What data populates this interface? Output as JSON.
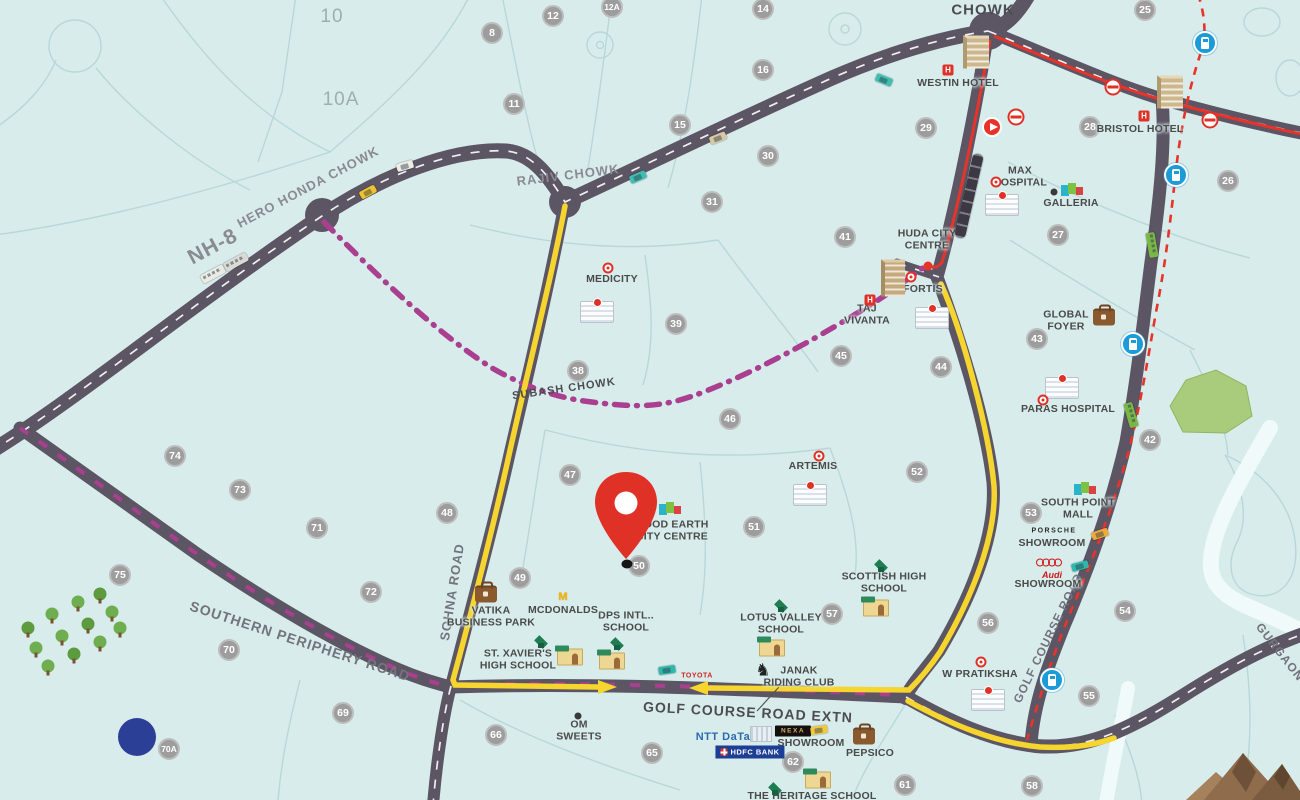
{
  "map": {
    "colors": {
      "background": "#d8ecec",
      "block_lines": "#b9d7d8",
      "road": "#5c5564",
      "route_yellow": "#f6d52f",
      "route_magenta": "#aa3f90",
      "route_red": "#e8332a",
      "pin_red": "#e03127",
      "sector_circle": "#9d9d9d",
      "metro_blue": "#1b9bd8",
      "park_green": "#a9cb7c",
      "mountain_brown": "#8f6d4c",
      "pond_blue": "#2b3f96"
    },
    "area_labels": [
      {
        "t": "10",
        "x": 332,
        "y": 17
      },
      {
        "t": "10A",
        "x": 341,
        "y": 100
      }
    ],
    "road_labels": [
      {
        "t": "NH-8",
        "x": 213,
        "y": 247,
        "s": 21,
        "r": -28,
        "cls": ""
      },
      {
        "t": "HERO HONDA CHOWK",
        "x": 308,
        "y": 187,
        "s": 13,
        "r": -28,
        "cls": ""
      },
      {
        "t": "RAJIV CHOWK",
        "x": 568,
        "y": 175,
        "s": 13,
        "r": -7,
        "cls": ""
      },
      {
        "t": "CHOWK",
        "x": 983,
        "y": 10,
        "s": 15,
        "r": 0,
        "cls": "dark"
      },
      {
        "t": "SUBASH CHOWK",
        "x": 564,
        "y": 389,
        "s": 11,
        "r": -8,
        "cls": "dark"
      },
      {
        "t": "SOHNA ROAD",
        "x": 452,
        "y": 592,
        "s": 13,
        "r": -81,
        "cls": "med"
      },
      {
        "t": "GOLF COURSE ROAD",
        "x": 1048,
        "y": 638,
        "s": 12,
        "r": -64,
        "cls": "med"
      },
      {
        "t": "GOLF COURSE ROAD EXTN",
        "x": 748,
        "y": 712,
        "s": 14,
        "r": 3,
        "cls": "dark"
      },
      {
        "t": "SOUTHERN PERIPHERY ROAD",
        "x": 300,
        "y": 641,
        "s": 14,
        "r": 18,
        "cls": "med"
      },
      {
        "t": "GURGAON",
        "x": 1280,
        "y": 652,
        "s": 12,
        "r": 52,
        "cls": "med"
      }
    ],
    "sectors": [
      {
        "n": "8",
        "x": 492,
        "y": 33
      },
      {
        "n": "11",
        "x": 514,
        "y": 104
      },
      {
        "n": "12",
        "x": 553,
        "y": 16
      },
      {
        "n": "12A",
        "x": 612,
        "y": 7
      },
      {
        "n": "14",
        "x": 763,
        "y": 9
      },
      {
        "n": "15",
        "x": 680,
        "y": 125
      },
      {
        "n": "16",
        "x": 763,
        "y": 70
      },
      {
        "n": "25",
        "x": 1145,
        "y": 10
      },
      {
        "n": "26",
        "x": 1228,
        "y": 181
      },
      {
        "n": "27",
        "x": 1058,
        "y": 235
      },
      {
        "n": "28",
        "x": 1090,
        "y": 127
      },
      {
        "n": "29",
        "x": 926,
        "y": 128
      },
      {
        "n": "30",
        "x": 768,
        "y": 156
      },
      {
        "n": "31",
        "x": 712,
        "y": 202
      },
      {
        "n": "38",
        "x": 578,
        "y": 371
      },
      {
        "n": "39",
        "x": 676,
        "y": 324
      },
      {
        "n": "41",
        "x": 845,
        "y": 237
      },
      {
        "n": "42",
        "x": 1150,
        "y": 440
      },
      {
        "n": "43",
        "x": 1037,
        "y": 339
      },
      {
        "n": "44",
        "x": 941,
        "y": 367
      },
      {
        "n": "45",
        "x": 841,
        "y": 356
      },
      {
        "n": "46",
        "x": 730,
        "y": 419
      },
      {
        "n": "47",
        "x": 570,
        "y": 475
      },
      {
        "n": "48",
        "x": 447,
        "y": 513
      },
      {
        "n": "49",
        "x": 520,
        "y": 578
      },
      {
        "n": "50",
        "x": 639,
        "y": 566
      },
      {
        "n": "51",
        "x": 754,
        "y": 527
      },
      {
        "n": "52",
        "x": 917,
        "y": 472
      },
      {
        "n": "53",
        "x": 1031,
        "y": 513
      },
      {
        "n": "54",
        "x": 1125,
        "y": 611
      },
      {
        "n": "55",
        "x": 1089,
        "y": 696
      },
      {
        "n": "56",
        "x": 988,
        "y": 623
      },
      {
        "n": "57",
        "x": 832,
        "y": 614
      },
      {
        "n": "58",
        "x": 1032,
        "y": 786
      },
      {
        "n": "61",
        "x": 905,
        "y": 785
      },
      {
        "n": "62",
        "x": 793,
        "y": 762
      },
      {
        "n": "65",
        "x": 652,
        "y": 753
      },
      {
        "n": "66",
        "x": 496,
        "y": 735
      },
      {
        "n": "69",
        "x": 343,
        "y": 713
      },
      {
        "n": "70",
        "x": 229,
        "y": 650
      },
      {
        "n": "70A",
        "x": 169,
        "y": 749
      },
      {
        "n": "71",
        "x": 317,
        "y": 528
      },
      {
        "n": "72",
        "x": 371,
        "y": 592
      },
      {
        "n": "73",
        "x": 240,
        "y": 490
      },
      {
        "n": "74",
        "x": 175,
        "y": 456
      },
      {
        "n": "75",
        "x": 120,
        "y": 575
      }
    ],
    "poi_labels": [
      {
        "t": "WESTIN HOTEL",
        "x": 958,
        "y": 83
      },
      {
        "t": "BRISTOL HOTEL",
        "x": 1140,
        "y": 129
      },
      {
        "t": "MAX\nHOSPITAL",
        "x": 1020,
        "y": 177
      },
      {
        "t": "GALLERIA",
        "x": 1071,
        "y": 203
      },
      {
        "t": "HUDA CITY\nCENTRE",
        "x": 927,
        "y": 240
      },
      {
        "t": "FORTIS",
        "x": 923,
        "y": 289
      },
      {
        "t": "TAJ\nVIVANTA",
        "x": 867,
        "y": 315
      },
      {
        "t": "MEDICITY",
        "x": 612,
        "y": 279
      },
      {
        "t": "GLOBAL\nFOYER",
        "x": 1066,
        "y": 321
      },
      {
        "t": "PARAS HOSPITAL",
        "x": 1068,
        "y": 409
      },
      {
        "t": "ARTEMIS",
        "x": 813,
        "y": 466
      },
      {
        "t": "GOOD EARTH\nCITY CENTRE",
        "x": 672,
        "y": 531
      },
      {
        "t": "SOUTH POINT\nMALL",
        "x": 1078,
        "y": 509
      },
      {
        "t": "SHOWROOM",
        "x": 1052,
        "y": 543
      },
      {
        "t": "SHOWROOM",
        "x": 1048,
        "y": 584
      },
      {
        "t": "SHOWROOM",
        "x": 811,
        "y": 743
      },
      {
        "t": "W PRATIKSHA",
        "x": 980,
        "y": 674
      },
      {
        "t": "SCOTTISH HIGH\nSCHOOL",
        "x": 884,
        "y": 583
      },
      {
        "t": "LOTUS VALLEY\nSCHOOL",
        "x": 781,
        "y": 624
      },
      {
        "t": "JANAK\nRIDING CLUB",
        "x": 799,
        "y": 677
      },
      {
        "t": "DPS INTL..\nSCHOOL",
        "x": 626,
        "y": 622
      },
      {
        "t": "ST. XAVIER'S\nHIGH SCHOOL",
        "x": 518,
        "y": 660
      },
      {
        "t": "MCDONALDS",
        "x": 563,
        "y": 610
      },
      {
        "t": "VATIKA\nBUSINESS PARK",
        "x": 491,
        "y": 617
      },
      {
        "t": "OM\nSWEETS",
        "x": 579,
        "y": 731
      },
      {
        "t": "PEPSICO",
        "x": 870,
        "y": 753
      },
      {
        "t": "THE HERITAGE SCHOOL",
        "x": 812,
        "y": 796
      }
    ],
    "logos": [
      {
        "t": "PORSCHE",
        "k": "porsche",
        "x": 1054,
        "y": 531
      },
      {
        "t": "Audi",
        "k": "audi-word",
        "x": 1052,
        "y": 575
      },
      {
        "t": "NTT DaTa",
        "k": "ntt",
        "x": 723,
        "y": 737
      },
      {
        "t": "TOYOTA",
        "k": "toyota",
        "x": 697,
        "y": 676
      },
      {
        "t": "NEXA",
        "k": "nexa",
        "x": 793,
        "y": 731
      },
      {
        "t": "HDFC BANK",
        "k": "hdfc",
        "x": 750,
        "y": 752
      }
    ],
    "icons": [
      {
        "k": "hotel",
        "name": "hotel-building-icon",
        "x": 976,
        "y": 52
      },
      {
        "k": "hotel",
        "name": "hotel-building-icon",
        "x": 1170,
        "y": 92
      },
      {
        "k": "hudabldg",
        "name": "tower-building-icon",
        "x": 893,
        "y": 278
      },
      {
        "k": "hbadge",
        "name": "hotel-h-badge-icon",
        "x": 948,
        "y": 70,
        "glyph": "H"
      },
      {
        "k": "hbadge",
        "name": "hotel-h-badge-icon",
        "x": 1144,
        "y": 116,
        "glyph": "H"
      },
      {
        "k": "hbadge",
        "name": "hotel-h-badge-icon",
        "x": 870,
        "y": 300,
        "glyph": "H"
      },
      {
        "k": "hospital",
        "name": "hospital-building-icon",
        "x": 1002,
        "y": 205
      },
      {
        "k": "hospital",
        "name": "hospital-building-icon",
        "x": 932,
        "y": 318
      },
      {
        "k": "hospital",
        "name": "hospital-building-icon",
        "x": 597,
        "y": 312
      },
      {
        "k": "hospital",
        "name": "hospital-building-icon",
        "x": 1062,
        "y": 388
      },
      {
        "k": "hospital",
        "name": "hospital-building-icon",
        "x": 810,
        "y": 495
      },
      {
        "k": "hospital",
        "name": "hospital-building-icon",
        "x": 988,
        "y": 700
      },
      {
        "k": "reddot",
        "name": "hospital-marker-icon",
        "x": 996,
        "y": 182
      },
      {
        "k": "reddot",
        "name": "hospital-marker-icon",
        "x": 608,
        "y": 268
      },
      {
        "k": "reddot",
        "name": "hospital-marker-icon",
        "x": 911,
        "y": 277
      },
      {
        "k": "reddot",
        "name": "hospital-marker-icon",
        "x": 819,
        "y": 456
      },
      {
        "k": "reddot",
        "name": "hospital-marker-icon",
        "x": 1043,
        "y": 400
      },
      {
        "k": "reddot",
        "name": "hospital-marker-icon",
        "x": 981,
        "y": 662
      },
      {
        "k": "blackdot",
        "name": "place-dot-icon",
        "x": 1054,
        "y": 192
      },
      {
        "k": "blackdot",
        "name": "place-dot-icon",
        "x": 578,
        "y": 716
      },
      {
        "k": "mall",
        "name": "mall-icon",
        "x": 1074,
        "y": 190
      },
      {
        "k": "mall",
        "name": "mall-icon",
        "x": 672,
        "y": 509
      },
      {
        "k": "mall",
        "name": "mall-icon",
        "x": 1087,
        "y": 489
      },
      {
        "k": "briefcase",
        "name": "business-park-icon",
        "x": 1104,
        "y": 317
      },
      {
        "k": "briefcase",
        "name": "business-park-icon",
        "x": 486,
        "y": 594
      },
      {
        "k": "briefcase",
        "name": "business-park-icon",
        "x": 864,
        "y": 736
      },
      {
        "k": "cap",
        "name": "graduation-cap-icon",
        "x": 881,
        "y": 565
      },
      {
        "k": "cap",
        "name": "graduation-cap-icon",
        "x": 781,
        "y": 605
      },
      {
        "k": "cap",
        "name": "graduation-cap-icon",
        "x": 617,
        "y": 643
      },
      {
        "k": "cap",
        "name": "graduation-cap-icon",
        "x": 541,
        "y": 641
      },
      {
        "k": "cap",
        "name": "graduation-cap-icon",
        "x": 775,
        "y": 788
      },
      {
        "k": "schoolb",
        "name": "school-building-icon",
        "x": 876,
        "y": 608
      },
      {
        "k": "schoolb",
        "name": "school-building-icon",
        "x": 772,
        "y": 648
      },
      {
        "k": "schoolb",
        "name": "school-building-icon",
        "x": 612,
        "y": 661
      },
      {
        "k": "schoolb",
        "name": "school-building-icon",
        "x": 570,
        "y": 657
      },
      {
        "k": "schoolb",
        "name": "school-building-icon",
        "x": 818,
        "y": 780
      },
      {
        "k": "metrologo",
        "name": "metro-logo-icon",
        "x": 1016,
        "y": 117
      },
      {
        "k": "metrologo",
        "name": "metro-logo-icon",
        "x": 1113,
        "y": 87
      },
      {
        "k": "metrologo",
        "name": "metro-logo-icon",
        "x": 1210,
        "y": 120
      },
      {
        "k": "train",
        "name": "rapid-metro-station-icon",
        "x": 1205,
        "y": 43
      },
      {
        "k": "train",
        "name": "rapid-metro-station-icon",
        "x": 1176,
        "y": 175
      },
      {
        "k": "train",
        "name": "rapid-metro-station-icon",
        "x": 1133,
        "y": 344
      },
      {
        "k": "train",
        "name": "rapid-metro-station-icon",
        "x": 1052,
        "y": 680
      },
      {
        "k": "navarrow",
        "name": "direction-arrow-icon",
        "x": 992,
        "y": 127
      },
      {
        "k": "horse",
        "name": "riding-club-horse-icon",
        "x": 763,
        "y": 671,
        "glyph": "♞"
      },
      {
        "k": "arches",
        "name": "mcdonalds-icon",
        "x": 563,
        "y": 597,
        "glyph": "M"
      },
      {
        "k": "rings",
        "name": "audi-rings-icon",
        "x": 1053,
        "y": 563
      },
      {
        "k": "ntb",
        "name": "office-building-icon",
        "x": 761,
        "y": 734
      }
    ],
    "vehicles": [
      {
        "k": "car",
        "x": 368,
        "y": 192,
        "r": -28,
        "c": "#f0c32e"
      },
      {
        "k": "car",
        "x": 405,
        "y": 166,
        "r": -16,
        "c": "#efece6"
      },
      {
        "k": "car",
        "x": 638,
        "y": 177,
        "r": -23,
        "c": "#3fbdb0"
      },
      {
        "k": "car",
        "x": 718,
        "y": 138,
        "r": -22,
        "c": "#d9c9a2"
      },
      {
        "k": "car",
        "x": 884,
        "y": 80,
        "r": 22,
        "c": "#3fbdb0"
      },
      {
        "k": "car",
        "x": 1100,
        "y": 534,
        "r": -18,
        "c": "#f0a93c"
      },
      {
        "k": "car",
        "x": 1080,
        "y": 566,
        "r": -15,
        "c": "#2fb7ab"
      },
      {
        "k": "car",
        "x": 819,
        "y": 730,
        "r": -8,
        "c": "#f2c83c"
      },
      {
        "k": "car",
        "x": 667,
        "y": 670,
        "r": -8,
        "c": "#2fb7ab"
      },
      {
        "k": "bus",
        "x": 213,
        "y": 274,
        "r": -28,
        "c": "#eceae4"
      },
      {
        "k": "bus",
        "x": 236,
        "y": 262,
        "r": -28,
        "c": "#dcdad4"
      },
      {
        "k": "bus",
        "x": 1152,
        "y": 245,
        "r": 80,
        "c": "#7ab648"
      },
      {
        "k": "bus",
        "x": 1131,
        "y": 415,
        "r": 74,
        "c": "#7ab648"
      },
      {
        "k": "traincar",
        "x": 969,
        "y": 196,
        "r": 13,
        "c": "#3c3844"
      }
    ],
    "trees": [
      [
        28,
        628
      ],
      [
        52,
        614
      ],
      [
        78,
        602
      ],
      [
        100,
        594
      ],
      [
        36,
        648
      ],
      [
        62,
        636
      ],
      [
        88,
        624
      ],
      [
        112,
        612
      ],
      [
        48,
        666
      ],
      [
        74,
        654
      ],
      [
        100,
        642
      ],
      [
        120,
        628
      ]
    ],
    "pond": {
      "x": 137,
      "y": 737
    },
    "pin": {
      "x": 626,
      "y": 562
    }
  }
}
